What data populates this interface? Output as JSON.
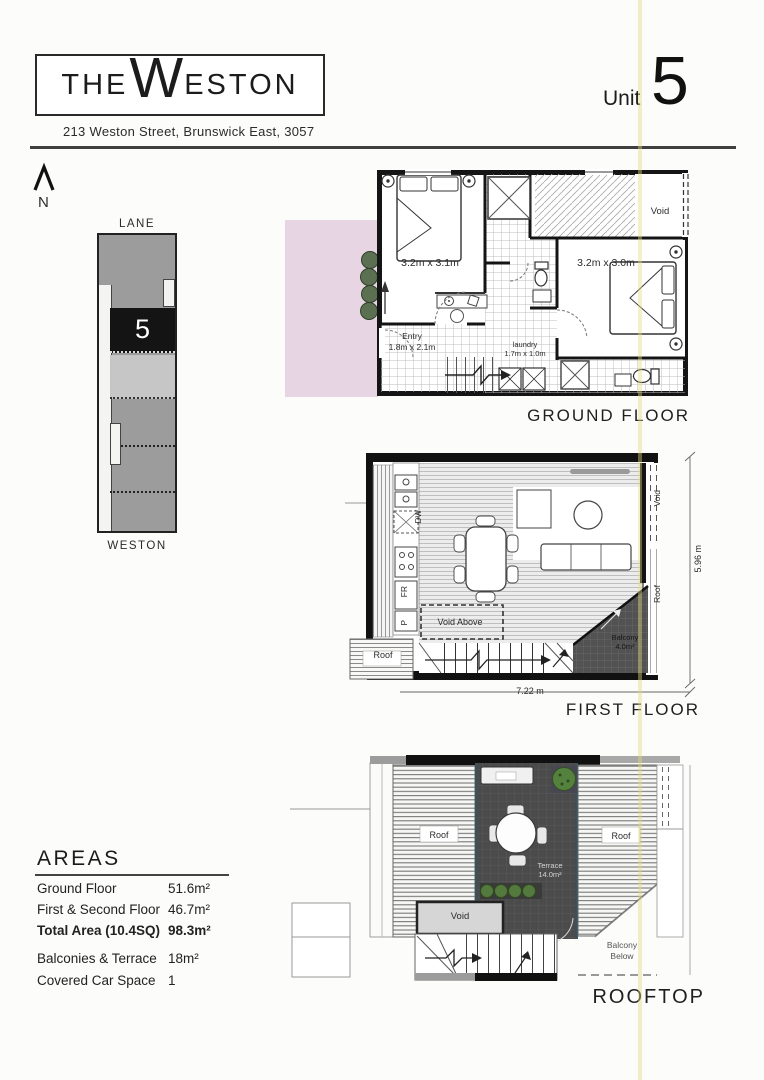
{
  "header": {
    "logo": {
      "the": "THE",
      "w": "W",
      "eston": "ESTON"
    },
    "address": "213 Weston Street, Brunswick East, 3057",
    "unit_label": "Unit",
    "unit_number": "5"
  },
  "site_plan": {
    "north": "N",
    "lane": "LANE",
    "weston": "WESTON",
    "unit": "5"
  },
  "ground_floor": {
    "label": "GROUND FLOOR",
    "bed1_dim": "3.2m x 3.1m",
    "bed2_dim": "3.2m x 3.0m",
    "void": "Void",
    "entry": "Entry",
    "entry_dim": "1.8m x 2.1m",
    "laundry": "laundry",
    "laundry_dim": "1.7m x 1.0m"
  },
  "first_floor": {
    "label": "FIRST FLOOR",
    "dw": "DW",
    "fr": "FR",
    "p": "P",
    "void_above": "Void Above",
    "void": "Void",
    "roof_side": "Roof",
    "roof_lower": "Roof",
    "balcony": "Balcony",
    "balcony_area": "4.0m²",
    "dim_width": "7.22 m",
    "dim_height": "5.96 m"
  },
  "rooftop": {
    "label": "ROOFTOP",
    "roof_left": "Roof",
    "roof_right": "Roof",
    "terrace": "Terrace",
    "terrace_area": "14.0m²",
    "void": "Void",
    "balcony_below_1": "Balcony",
    "balcony_below_2": "Below"
  },
  "areas": {
    "title": "AREAS",
    "rows": [
      {
        "label": "Ground Floor",
        "value": "51.6m²"
      },
      {
        "label": "First & Second Floor",
        "value": "46.7m²"
      },
      {
        "label": "Total Area (10.4SQ)",
        "value": "98.3m²"
      },
      {
        "label": "Balconies & Terrace",
        "value": "18m²"
      },
      {
        "label": "Covered Car Space",
        "value": "1"
      }
    ]
  }
}
